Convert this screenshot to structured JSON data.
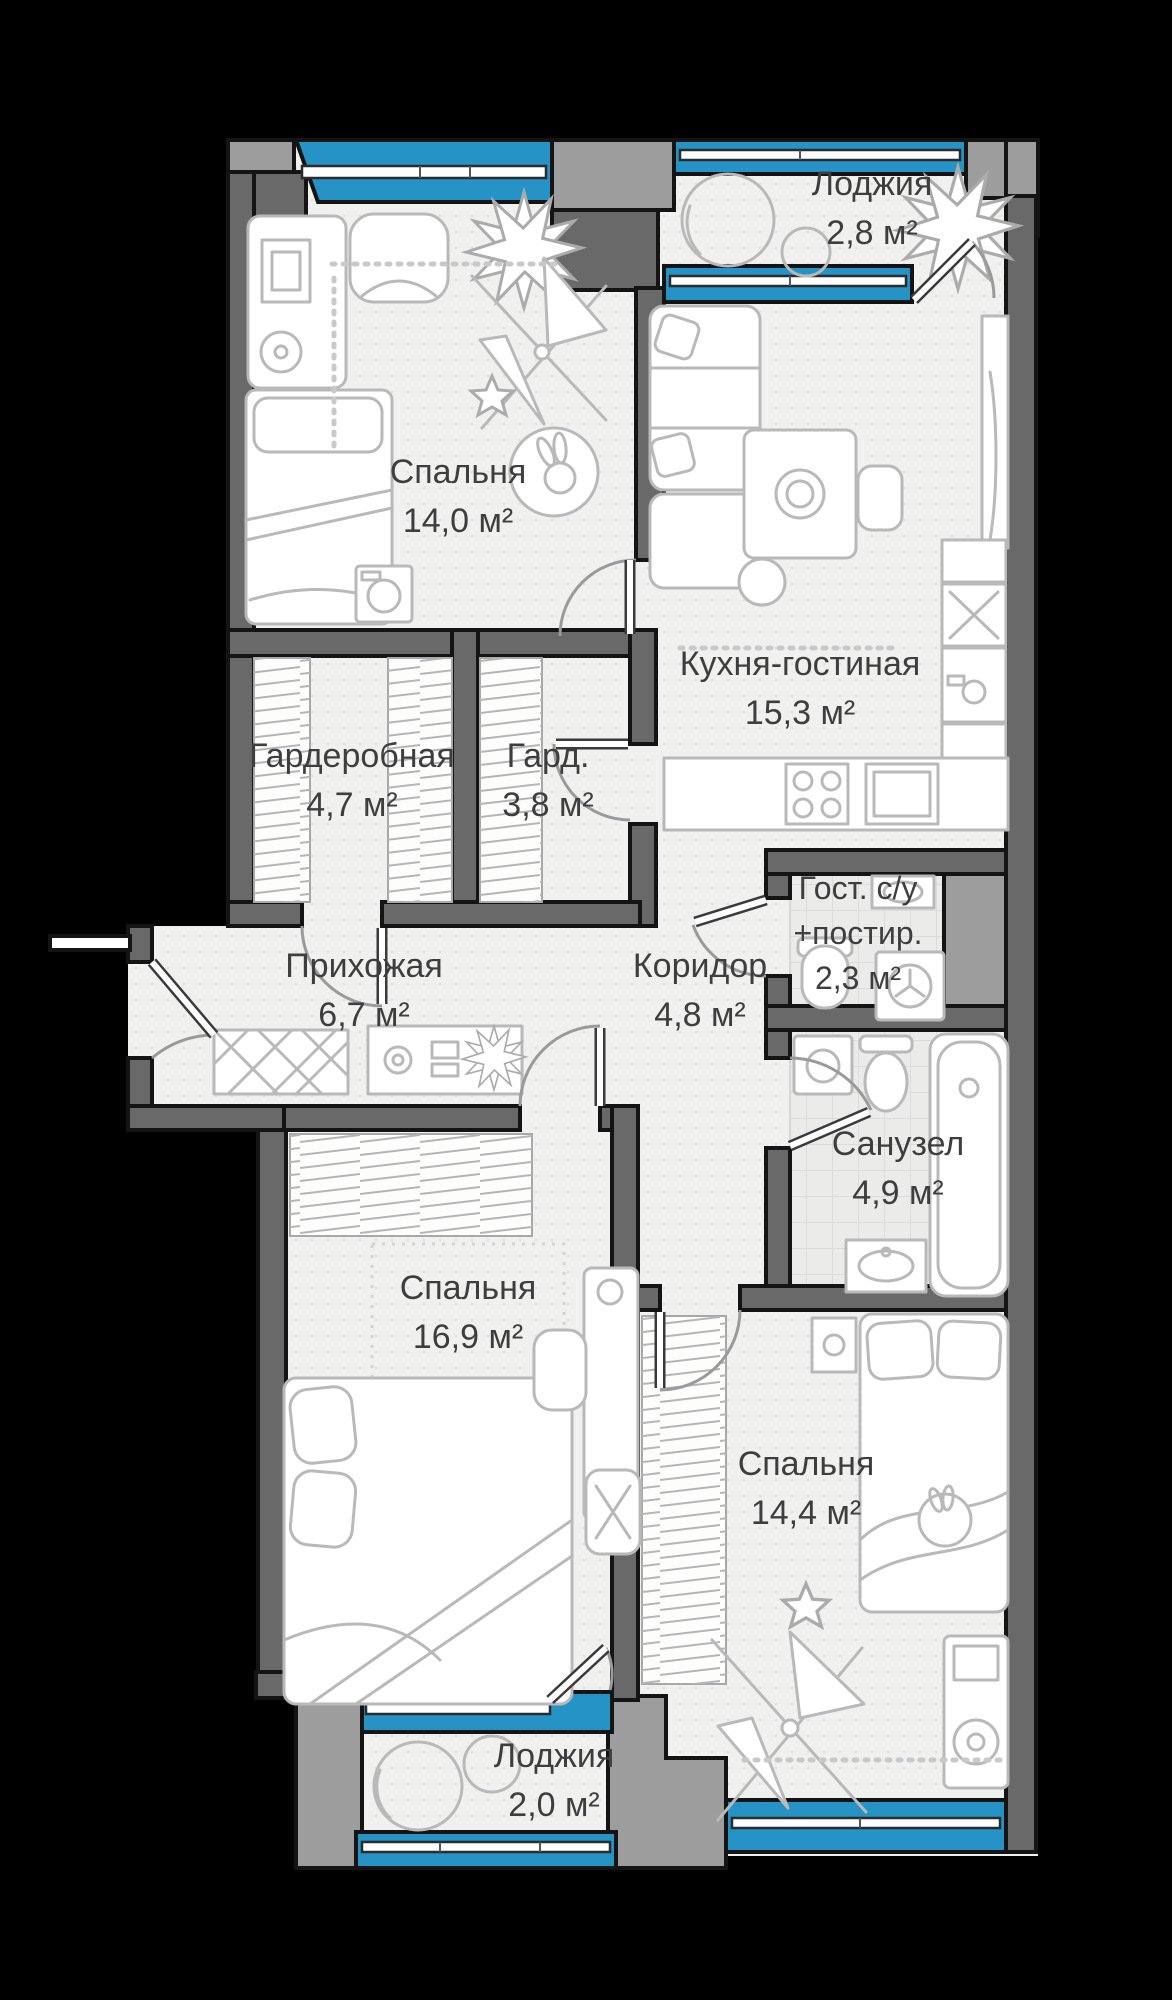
{
  "rooms": {
    "loggia_top": {
      "name": "Лоджия",
      "area": "2,8 м²"
    },
    "bedroom_top": {
      "name": "Спальня",
      "area": "14,0 м²"
    },
    "kitchen": {
      "name": "Кухня-гостиная",
      "area": "15,3 м²"
    },
    "wardrobe_big": {
      "name": "Гардеробная",
      "area": "4,7 м²"
    },
    "wardrobe_small": {
      "name": "Гард.",
      "area": "3,8 м²"
    },
    "guest_bath": {
      "name": "Гост. с/у",
      "name2": "+постир.",
      "area": "2,3 м²"
    },
    "hallway": {
      "name": "Прихожая",
      "area": "6,7 м²"
    },
    "corridor": {
      "name": "Коридор",
      "area": "4,8 м²"
    },
    "bathroom": {
      "name": "Санузел",
      "area": "4,9 м²"
    },
    "bedroom_mid": {
      "name": "Спальня",
      "area": "16,9 м²"
    },
    "bedroom_bottom": {
      "name": "Спальня",
      "area": "14,4 м²"
    },
    "loggia_bottom": {
      "name": "Лоджия",
      "area": "2,0 м²"
    }
  },
  "colors": {
    "window_blue": "#2593c6",
    "wall_dark": "#696969",
    "wall_light": "#9d9d9d",
    "outline": "#141414",
    "floor": "#f0f0ee",
    "furniture": "#b9b9b9",
    "text": "#3e3e3e",
    "background": "#000000"
  }
}
